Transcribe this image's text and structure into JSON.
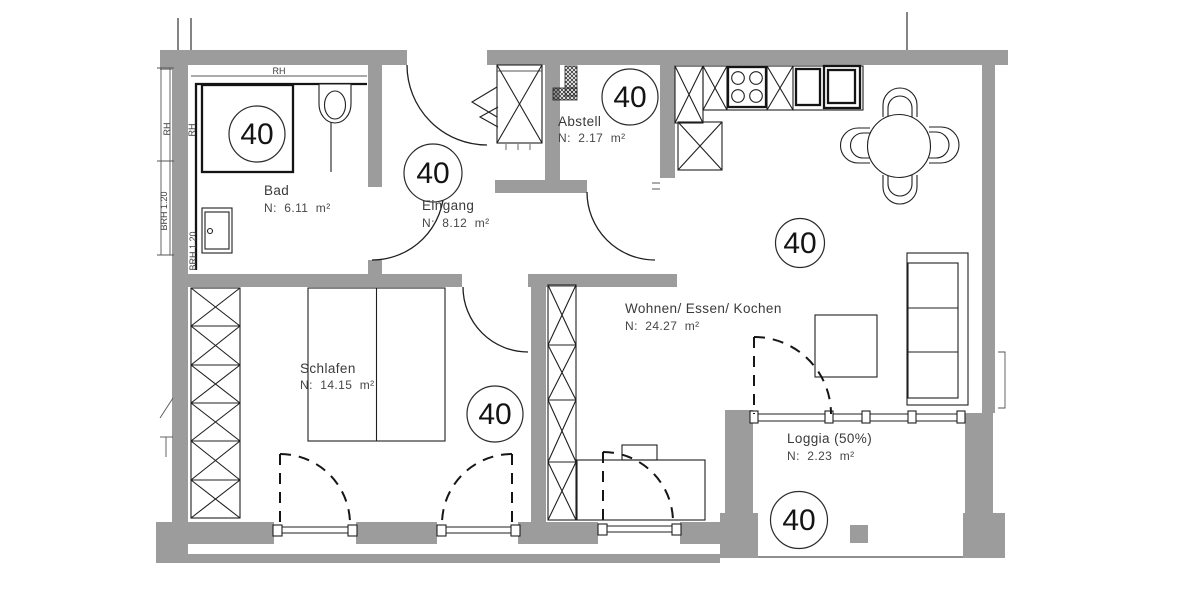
{
  "plan": {
    "unit_number": "40",
    "rooms": {
      "bad": {
        "name": "Bad",
        "area": "N:  6.11  m²"
      },
      "eingang": {
        "name": "Eingang",
        "area": "N:  8.12  m²"
      },
      "abstell": {
        "name": "Abstell",
        "area": "N:  2.17  m²"
      },
      "wohnen": {
        "name": "Wohnen/ Essen/ Kochen",
        "area": "N:  24.27  m²"
      },
      "schlafen": {
        "name": "Schlafen",
        "area": "N:  14.15  m²"
      },
      "loggia": {
        "name": "Loggia (50%)",
        "area": "N:  2.23  m²"
      }
    },
    "annotations": {
      "rh": "RH",
      "brh": "BRH 1.20"
    },
    "colors": {
      "wall": "#9c9c9c",
      "line": "#1f1f1f",
      "text": "#3a3a3a"
    }
  }
}
